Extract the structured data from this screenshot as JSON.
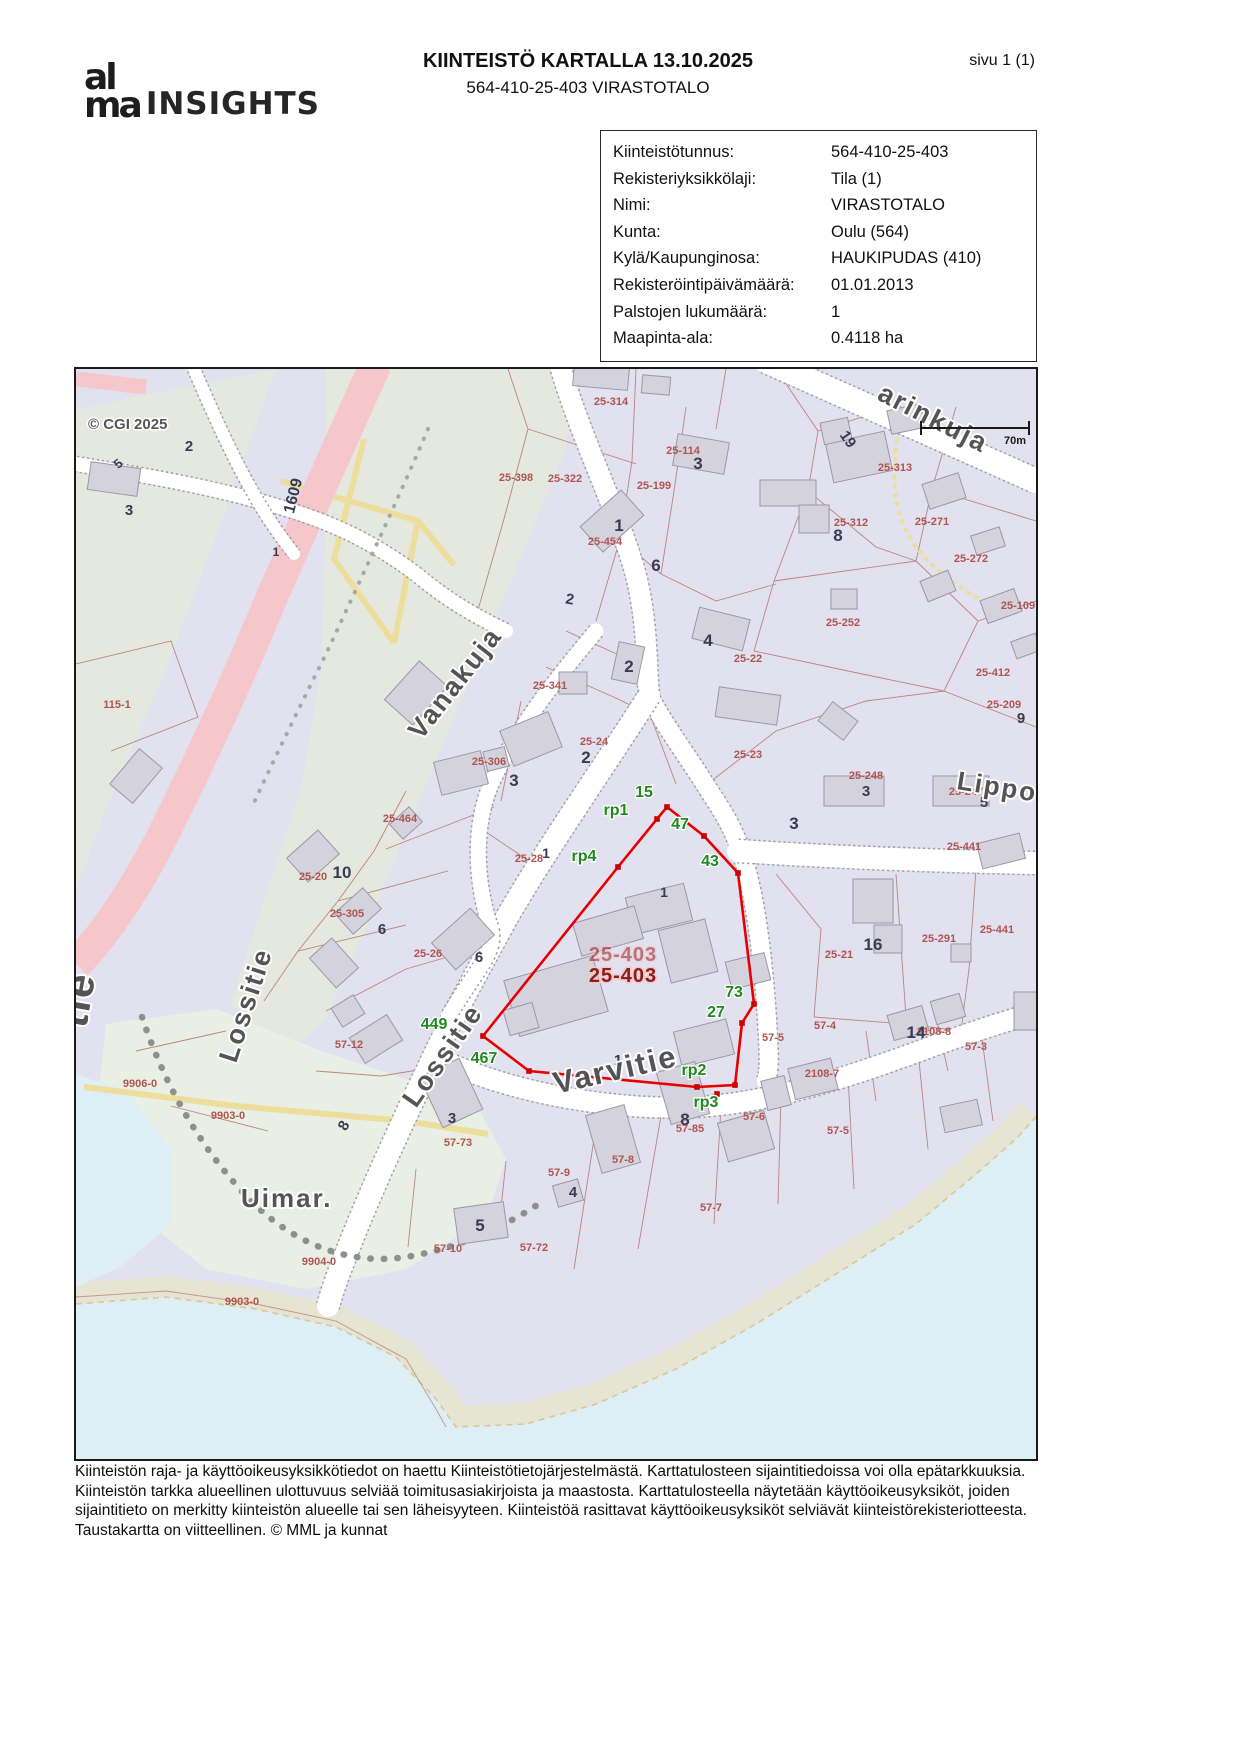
{
  "header": {
    "logo_top": "al",
    "logo_bottom": "ma",
    "logo_suffix": "INSIGHTS",
    "title": "KIINTEISTÖ KARTALLA 13.10.2025",
    "subtitle": "564-410-25-403 VIRASTOTALO",
    "page_label": "sivu 1 (1)"
  },
  "property_info": {
    "rows": [
      {
        "label": "Kiinteistötunnus:",
        "value": "564-410-25-403"
      },
      {
        "label": "Rekisteriyksikkölaji:",
        "value": "Tila (1)"
      },
      {
        "label": "Nimi:",
        "value": "VIRASTOTALO"
      },
      {
        "label": "Kunta:",
        "value": "Oulu (564)"
      },
      {
        "label": "Kylä/Kaupunginosa:",
        "value": "HAUKIPUDAS (410)"
      },
      {
        "label": "Rekisteröintipäivämäärä:",
        "value": "01.01.2013"
      },
      {
        "label": "Palstojen lukumäärä:",
        "value": "1"
      },
      {
        "label": "Maapinta-ala:",
        "value": "0.4118 ha"
      }
    ]
  },
  "map": {
    "copyright": {
      "t": "© CGI 2025",
      "x": 12,
      "y": 60
    },
    "scale": {
      "label": "70m"
    },
    "highlight": {
      "id": "25-403",
      "color": "#e60000",
      "big_label": {
        "t": "25-403",
        "x": 547,
        "y": 613
      },
      "faint_label": {
        "t": "25-403",
        "x": 547,
        "y": 592
      }
    },
    "street_labels": [
      {
        "t": "Vanakuja",
        "x": 345,
        "y": 372,
        "r": -52,
        "s": 27
      },
      {
        "t": "Lossitie",
        "x": 160,
        "y": 695,
        "r": -72,
        "s": 27
      },
      {
        "t": "Lossitie",
        "x": 340,
        "y": 740,
        "r": -55,
        "s": 27
      },
      {
        "t": "Varvitie",
        "x": 480,
        "y": 725,
        "r": -13,
        "s": 31
      },
      {
        "t": "arinkuja",
        "x": 800,
        "y": 30,
        "r": 27,
        "s": 27
      },
      {
        "t": "Lippo",
        "x": 880,
        "y": 420,
        "r": 9,
        "s": 26
      },
      {
        "t": "Uimar.",
        "x": 165,
        "y": 838,
        "s": 26,
        "c": "#6f6f6f"
      },
      {
        "t": "tie",
        "x": 10,
        "y": 660,
        "r": -80,
        "s": 42,
        "c": "#565656"
      }
    ],
    "parcel_labels": [
      {
        "t": "25-398",
        "x": 440,
        "y": 112
      },
      {
        "t": "25-322",
        "x": 489,
        "y": 113
      },
      {
        "t": "25-314",
        "x": 535,
        "y": 36
      },
      {
        "t": "25-114",
        "x": 607,
        "y": 85
      },
      {
        "t": "25-199",
        "x": 578,
        "y": 120
      },
      {
        "t": "25-454",
        "x": 529,
        "y": 176
      },
      {
        "t": "25-313",
        "x": 819,
        "y": 102
      },
      {
        "t": "25-312",
        "x": 775,
        "y": 157
      },
      {
        "t": "25-272",
        "x": 895,
        "y": 193
      },
      {
        "t": "25-271",
        "x": 856,
        "y": 156
      },
      {
        "t": "25-252",
        "x": 767,
        "y": 257
      },
      {
        "t": "25-22",
        "x": 672,
        "y": 293
      },
      {
        "t": "25-341",
        "x": 474,
        "y": 320
      },
      {
        "t": "25-306",
        "x": 413,
        "y": 396
      },
      {
        "t": "25-24",
        "x": 518,
        "y": 376
      },
      {
        "t": "25-412",
        "x": 917,
        "y": 307
      },
      {
        "t": "25-109",
        "x": 942,
        "y": 240
      },
      {
        "t": "25-209",
        "x": 928,
        "y": 339
      },
      {
        "t": "25-23",
        "x": 672,
        "y": 389
      },
      {
        "t": "25-248",
        "x": 790,
        "y": 410
      },
      {
        "t": "25-247",
        "x": 890,
        "y": 426
      },
      {
        "t": "25-441",
        "x": 888,
        "y": 481
      },
      {
        "t": "25-441",
        "x": 921,
        "y": 564
      },
      {
        "t": "25-291",
        "x": 863,
        "y": 573
      },
      {
        "t": "25-21",
        "x": 763,
        "y": 589
      },
      {
        "t": "25-464",
        "x": 324,
        "y": 453
      },
      {
        "t": "25-20",
        "x": 237,
        "y": 511
      },
      {
        "t": "25-305",
        "x": 271,
        "y": 548
      },
      {
        "t": "25-26",
        "x": 352,
        "y": 588
      },
      {
        "t": "25-28",
        "x": 453,
        "y": 493
      },
      {
        "t": "115-1",
        "x": 41,
        "y": 339
      },
      {
        "t": "57-12",
        "x": 273,
        "y": 679
      },
      {
        "t": "9906-0",
        "x": 64,
        "y": 718
      },
      {
        "t": "9903-0",
        "x": 152,
        "y": 750
      },
      {
        "t": "9904-0",
        "x": 243,
        "y": 896
      },
      {
        "t": "9903-0",
        "x": 166,
        "y": 936
      },
      {
        "t": "57-73",
        "x": 382,
        "y": 777
      },
      {
        "t": "57-9",
        "x": 483,
        "y": 807
      },
      {
        "t": "57-8",
        "x": 547,
        "y": 794
      },
      {
        "t": "57-85",
        "x": 614,
        "y": 763
      },
      {
        "t": "57-6",
        "x": 678,
        "y": 751
      },
      {
        "t": "57-5",
        "x": 697,
        "y": 672
      },
      {
        "t": "57-5",
        "x": 762,
        "y": 765
      },
      {
        "t": "57-4",
        "x": 749,
        "y": 660
      },
      {
        "t": "57-3",
        "x": 900,
        "y": 681
      },
      {
        "t": "2108-7",
        "x": 746,
        "y": 708
      },
      {
        "t": "2108-8",
        "x": 858,
        "y": 666
      },
      {
        "t": "57-10",
        "x": 372,
        "y": 883
      },
      {
        "t": "57-72",
        "x": 458,
        "y": 882
      },
      {
        "t": "57-7",
        "x": 635,
        "y": 842
      }
    ],
    "house_numbers": [
      {
        "t": "3",
        "x": 622,
        "y": 100,
        "s": 17
      },
      {
        "t": "1",
        "x": 543,
        "y": 162,
        "s": 17
      },
      {
        "t": "8",
        "x": 762,
        "y": 172,
        "s": 17
      },
      {
        "t": "6",
        "x": 580,
        "y": 202,
        "s": 17
      },
      {
        "t": "4",
        "x": 632,
        "y": 277,
        "s": 17
      },
      {
        "t": "2",
        "x": 553,
        "y": 303,
        "s": 17
      },
      {
        "t": "2",
        "x": 510,
        "y": 394,
        "s": 17
      },
      {
        "t": "3",
        "x": 438,
        "y": 417,
        "s": 17
      },
      {
        "t": "1",
        "x": 470,
        "y": 489,
        "s": 14
      },
      {
        "t": "10",
        "x": 266,
        "y": 509,
        "s": 17
      },
      {
        "t": "6",
        "x": 306,
        "y": 565,
        "s": 15
      },
      {
        "t": "6",
        "x": 403,
        "y": 593,
        "s": 15
      },
      {
        "t": "3",
        "x": 718,
        "y": 460,
        "s": 17
      },
      {
        "t": "3",
        "x": 790,
        "y": 427,
        "s": 15
      },
      {
        "t": "5",
        "x": 908,
        "y": 438,
        "s": 15
      },
      {
        "t": "16",
        "x": 797,
        "y": 581,
        "s": 17
      },
      {
        "t": "9",
        "x": 945,
        "y": 354,
        "s": 15
      },
      {
        "t": "1",
        "x": 588,
        "y": 528,
        "s": 14
      },
      {
        "t": "1",
        "x": 542,
        "y": 696,
        "s": 15
      },
      {
        "t": "7",
        "x": 486,
        "y": 719,
        "s": 13,
        "r": -20
      },
      {
        "t": "14",
        "x": 840,
        "y": 669,
        "s": 17
      },
      {
        "t": "8",
        "x": 609,
        "y": 756,
        "s": 17
      },
      {
        "t": "4",
        "x": 497,
        "y": 828,
        "s": 15
      },
      {
        "t": "3",
        "x": 376,
        "y": 754,
        "s": 15
      },
      {
        "t": "5",
        "x": 404,
        "y": 862,
        "s": 17
      },
      {
        "t": "5",
        "x": 45,
        "y": 98,
        "s": 13,
        "r": -40
      },
      {
        "t": "3",
        "x": 53,
        "y": 146,
        "s": 15
      },
      {
        "t": "2",
        "x": 113,
        "y": 82,
        "s": 15
      },
      {
        "t": "19",
        "x": 768,
        "y": 73,
        "s": 15,
        "r": 55
      },
      {
        "t": "8",
        "x": 272,
        "y": 759,
        "s": 15,
        "r": -60
      },
      {
        "t": "2",
        "x": 493,
        "y": 235,
        "s": 15,
        "r": 10
      },
      {
        "t": "1609",
        "x": 222,
        "y": 128,
        "s": 16,
        "r": -76,
        "c": "#555566"
      },
      {
        "t": "1",
        "x": 200,
        "y": 187,
        "s": 12
      }
    ],
    "boundary_point_labels": [
      {
        "t": "15",
        "x": 568,
        "y": 428
      },
      {
        "t": "rp1",
        "x": 540,
        "y": 446
      },
      {
        "t": "47",
        "x": 604,
        "y": 460
      },
      {
        "t": "rp4",
        "x": 508,
        "y": 492
      },
      {
        "t": "43",
        "x": 634,
        "y": 497
      },
      {
        "t": "73",
        "x": 658,
        "y": 628
      },
      {
        "t": "27",
        "x": 640,
        "y": 648
      },
      {
        "t": "rp2",
        "x": 618,
        "y": 706
      },
      {
        "t": "rp3",
        "x": 630,
        "y": 738
      },
      {
        "t": "449",
        "x": 358,
        "y": 660
      },
      {
        "t": "467",
        "x": 408,
        "y": 694
      }
    ]
  },
  "footer": {
    "lines": [
      "Kiinteistön raja- ja käyttöoikeusyksikkötiedot on haettu Kiinteistötietojärjestelmästä. Karttatulosteen sijaintitiedoissa voi olla epätarkkuuksia.",
      "Kiinteistön tarkka alueellinen ulottuvuus selviää toimitusasiakirjoista ja maastosta. Karttatulosteella näytetään käyttöoikeusyksiköt, joiden",
      "sijaintitieto on merkitty kiinteistön alueelle tai sen läheisyyteen. Kiinteistöä rasittavat käyttöoikeusyksiköt selviävät kiinteistörekisteriotteesta.",
      "Taustakartta on viitteellinen. © MML ja kunnat"
    ]
  }
}
